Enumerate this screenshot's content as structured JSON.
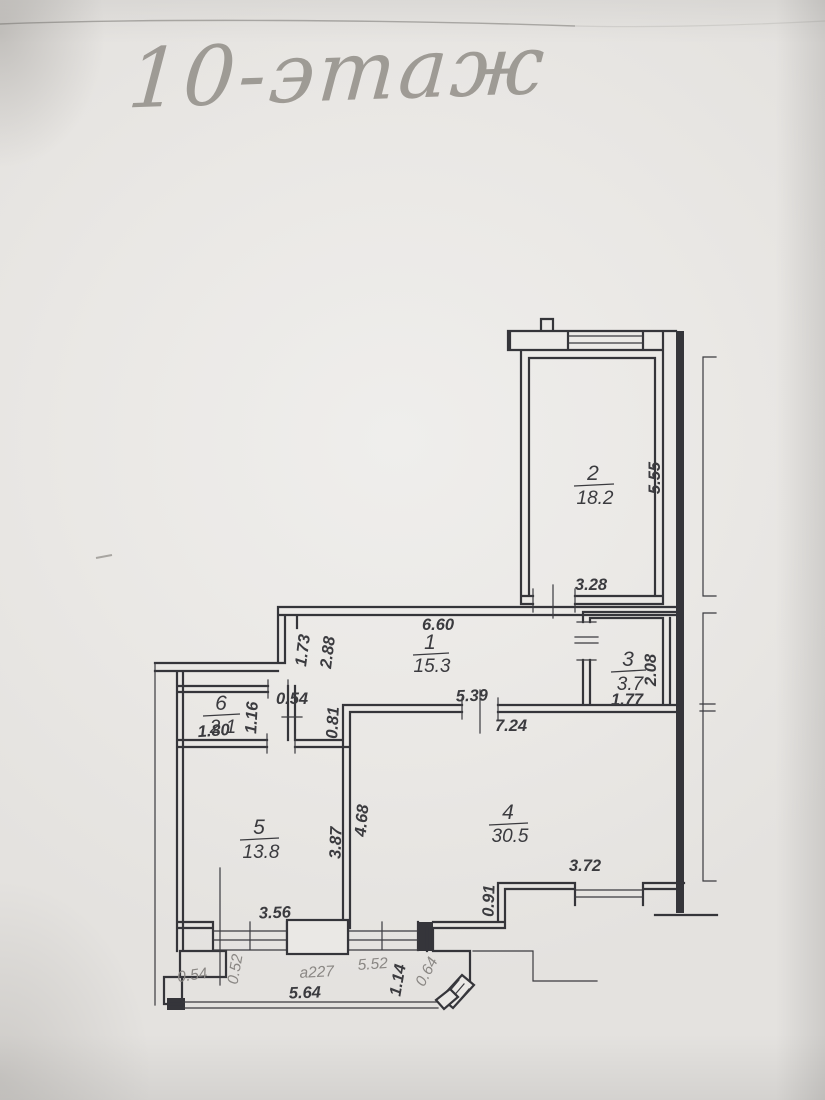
{
  "page": {
    "handwritten_title": "10-этаж",
    "document_type_note": "scanned apartment floor plan, pencil title on paper"
  },
  "colors": {
    "paper": "#eae8e5",
    "ink": "#35353a",
    "pencil": "#97938d",
    "dim_text": "#3b3b3f",
    "faint_text": "#8a8784"
  },
  "plan": {
    "rooms": [
      {
        "number": "1",
        "area": "15.3",
        "nx": 430,
        "ny": 649,
        "ax": 432,
        "ay": 672,
        "ly": 655,
        "lx1": 413,
        "lx2": 449
      },
      {
        "number": "2",
        "area": "18.2",
        "nx": 593,
        "ny": 480,
        "ax": 595,
        "ay": 504,
        "ly": 486,
        "lx1": 574,
        "lx2": 614
      },
      {
        "number": "3",
        "area": "3.7",
        "nx": 628,
        "ny": 666,
        "ax": 630,
        "ay": 690,
        "ly": 672,
        "lx1": 611,
        "lx2": 646
      },
      {
        "number": "4",
        "area": "30.5",
        "nx": 508,
        "ny": 819,
        "ax": 510,
        "ay": 842,
        "ly": 825,
        "lx1": 489,
        "lx2": 528
      },
      {
        "number": "5",
        "area": "13.8",
        "nx": 259,
        "ny": 834,
        "ax": 261,
        "ay": 858,
        "ly": 840,
        "lx1": 240,
        "lx2": 279
      },
      {
        "number": "6",
        "area": "2.1",
        "nx": 221,
        "ny": 710,
        "ax": 223,
        "ay": 733,
        "ly": 716,
        "lx1": 203,
        "lx2": 240
      }
    ],
    "dimensions": [
      {
        "t": "6.60",
        "x": 438,
        "y": 630,
        "r": 0,
        "s": "d"
      },
      {
        "t": "3.28",
        "x": 591,
        "y": 590,
        "r": 0,
        "s": "d"
      },
      {
        "t": "5.55",
        "x": 660,
        "y": 478,
        "r": -90,
        "s": "d"
      },
      {
        "t": "1.73",
        "x": 308,
        "y": 651,
        "r": -83,
        "s": "d"
      },
      {
        "t": "2.88",
        "x": 333,
        "y": 653,
        "r": -83,
        "s": "d"
      },
      {
        "t": "0.54",
        "x": 292,
        "y": 704,
        "r": 0,
        "s": "d"
      },
      {
        "t": "1.16",
        "x": 257,
        "y": 718,
        "r": -87,
        "s": "d"
      },
      {
        "t": "1.80",
        "x": 214,
        "y": 736,
        "r": -4,
        "s": "d"
      },
      {
        "t": "0.81",
        "x": 338,
        "y": 723,
        "r": -87,
        "s": "d"
      },
      {
        "t": "5.39",
        "x": 472,
        "y": 701,
        "r": -2,
        "s": "d"
      },
      {
        "t": "7.24",
        "x": 511,
        "y": 731,
        "r": 0,
        "s": "d"
      },
      {
        "t": "1.77",
        "x": 627,
        "y": 705,
        "r": 0,
        "s": "d"
      },
      {
        "t": "2.08",
        "x": 656,
        "y": 670,
        "r": -90,
        "s": "d"
      },
      {
        "t": "3.87",
        "x": 341,
        "y": 843,
        "r": -88,
        "s": "d"
      },
      {
        "t": "4.68",
        "x": 367,
        "y": 821,
        "r": -85,
        "s": "d"
      },
      {
        "t": "3.56",
        "x": 275,
        "y": 918,
        "r": -2,
        "s": "d"
      },
      {
        "t": "3.72",
        "x": 585,
        "y": 871,
        "r": 0,
        "s": "d"
      },
      {
        "t": "0.91",
        "x": 494,
        "y": 901,
        "r": -88,
        "s": "d"
      },
      {
        "t": "0.54",
        "x": 193,
        "y": 980,
        "r": -8,
        "s": "m"
      },
      {
        "t": "0.52",
        "x": 240,
        "y": 970,
        "r": -80,
        "s": "m"
      },
      {
        "t": "a227",
        "x": 317,
        "y": 977,
        "r": -3,
        "s": "m"
      },
      {
        "t": "5.64",
        "x": 305,
        "y": 998,
        "r": -2,
        "s": "d"
      },
      {
        "t": "5.52",
        "x": 373,
        "y": 969,
        "r": -4,
        "s": "m"
      },
      {
        "t": "1.14",
        "x": 403,
        "y": 981,
        "r": -80,
        "s": "d"
      },
      {
        "t": "0.64",
        "x": 431,
        "y": 974,
        "r": -62,
        "s": "m"
      }
    ]
  }
}
